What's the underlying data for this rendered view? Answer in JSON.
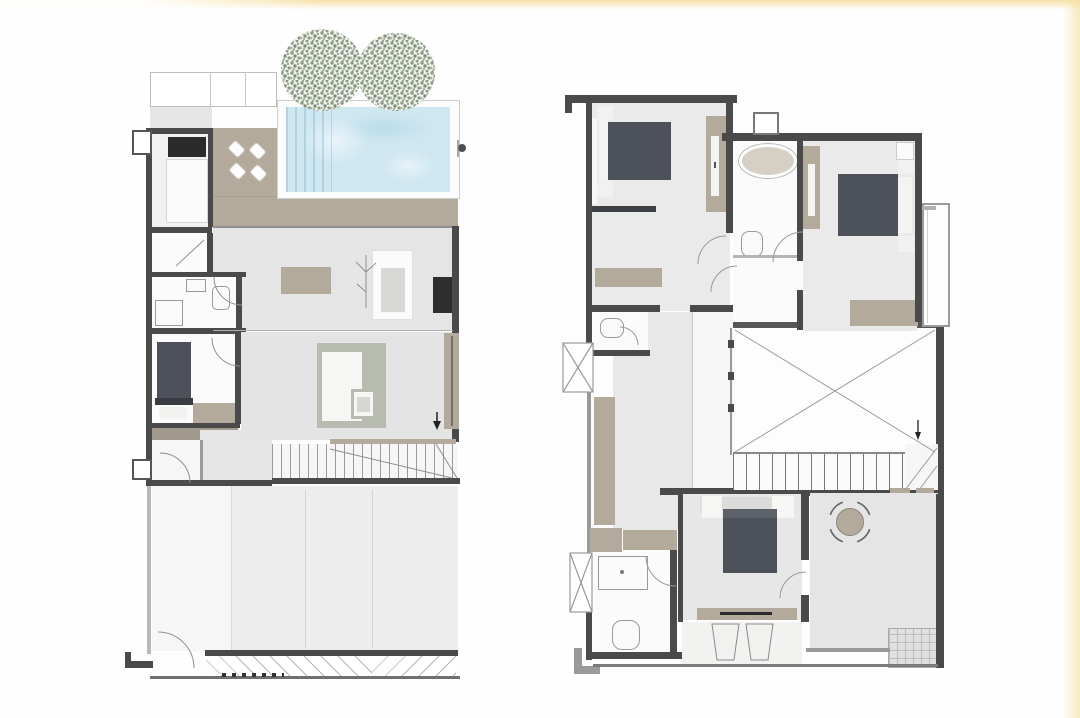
{
  "scene": {
    "type": "architectural-floor-plan",
    "description": "Presentation sheet with two rendered floor plans of a two-storey house, no text labels",
    "plans": [
      {
        "id": "ground-floor",
        "position": "left",
        "visible_objects": [
          "two-trees",
          "swimming-pool",
          "pool-deck",
          "outdoor-chairs",
          "kitchen-counter",
          "kitchen-cabinet",
          "kitchen-island",
          "dining-table",
          "plant",
          "tv-cabinet",
          "bathroom-fixtures",
          "bed",
          "wardrobe-strips",
          "l-shaped-sofa",
          "coffee-table",
          "stairs",
          "entry-door-swing",
          "garage",
          "garage-door-swing",
          "hatched-driveway",
          "scale-marks",
          "window-boxes"
        ]
      },
      {
        "id": "upper-floor",
        "position": "right",
        "visible_objects": [
          "bed-front",
          "bed-right",
          "bed-lower",
          "wardrobes",
          "desks",
          "oval-bathtub",
          "toilets",
          "shower",
          "vent-box",
          "double-height-void-cross",
          "stairs-with-balustrade",
          "hallway-closet",
          "window-bays-with-cross",
          "balcony",
          "round-table-with-four-chairs",
          "grid-mat",
          "stools",
          "door-swings"
        ]
      }
    ]
  },
  "colors": {
    "background": "#fefefe",
    "glow": "#f6e2a8",
    "wall": "#4a4a4a",
    "wall-light": "#9a9a9a",
    "floor": "#e6e6e7",
    "deck": "#b3aa9b",
    "bed": "#4d5159",
    "counter": "#2b2b2b",
    "sofa": "#b8bcb0",
    "pool-water": "#cfe7f1",
    "tree-dot": "#8b9a84",
    "tree-dot-light": "#aab6a2",
    "line": "#8f8f8f"
  }
}
